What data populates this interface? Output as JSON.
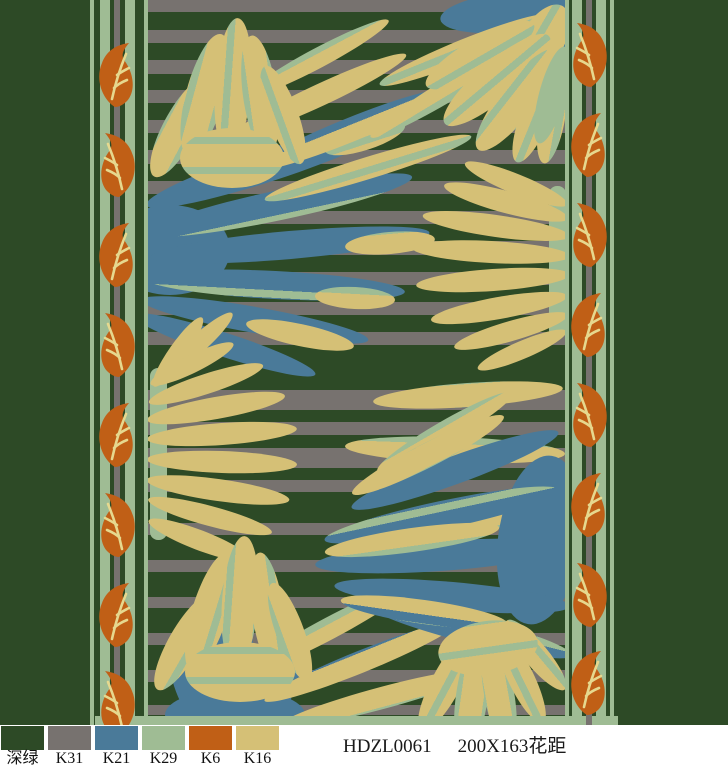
{
  "palette": {
    "swatches": [
      {
        "label": "深绿",
        "hex": "#2d4a26"
      },
      {
        "label": "K31",
        "hex": "#77726f"
      },
      {
        "label": "K21",
        "hex": "#4a7a99"
      },
      {
        "label": "K29",
        "hex": "#9fbc94"
      },
      {
        "label": "K6",
        "hex": "#c05f16"
      },
      {
        "label": "K16",
        "hex": "#d5c076"
      }
    ]
  },
  "footer": {
    "code": "HDZL0061",
    "spec": "200X163花距"
  }
}
